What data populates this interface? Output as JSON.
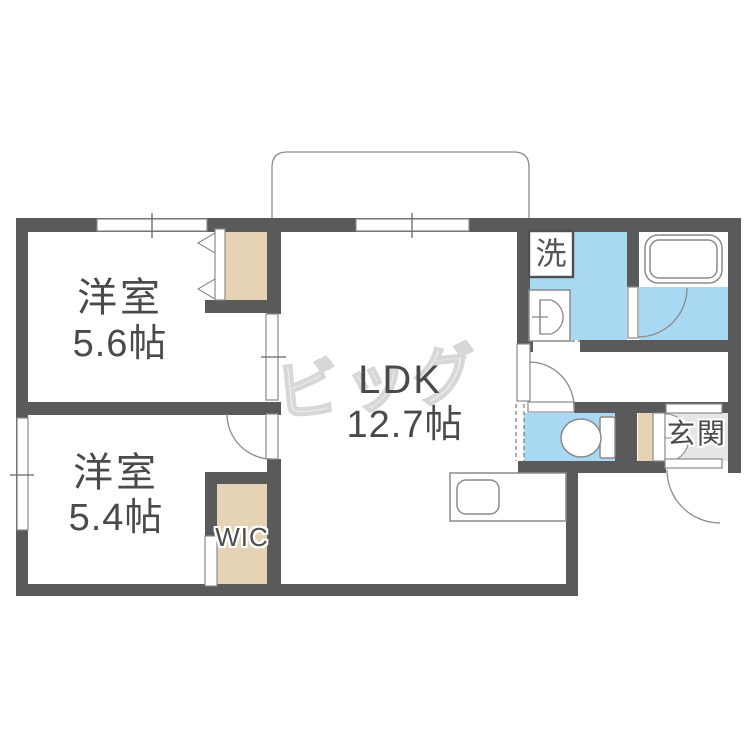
{
  "plan": {
    "watermark": "ビッグ",
    "rooms": {
      "ldk": {
        "name": "LDK",
        "size": "12.7帖"
      },
      "bedroom1": {
        "name": "洋室",
        "size": "5.6帖"
      },
      "bedroom2": {
        "name": "洋室",
        "size": "5.4帖"
      },
      "wic": {
        "label": "WIC"
      },
      "entrance": {
        "label": "玄関"
      },
      "laundry": {
        "label": "洗"
      }
    },
    "colors": {
      "wall": "#5a5a5a",
      "water_area": "#a9d8f2",
      "storage": "#e6d3b5",
      "entrance_floor": "#e6e6e6",
      "label_text": "#4a4a4a",
      "outline": "#8a8a8a",
      "watermark": "#d7d7d7"
    }
  }
}
